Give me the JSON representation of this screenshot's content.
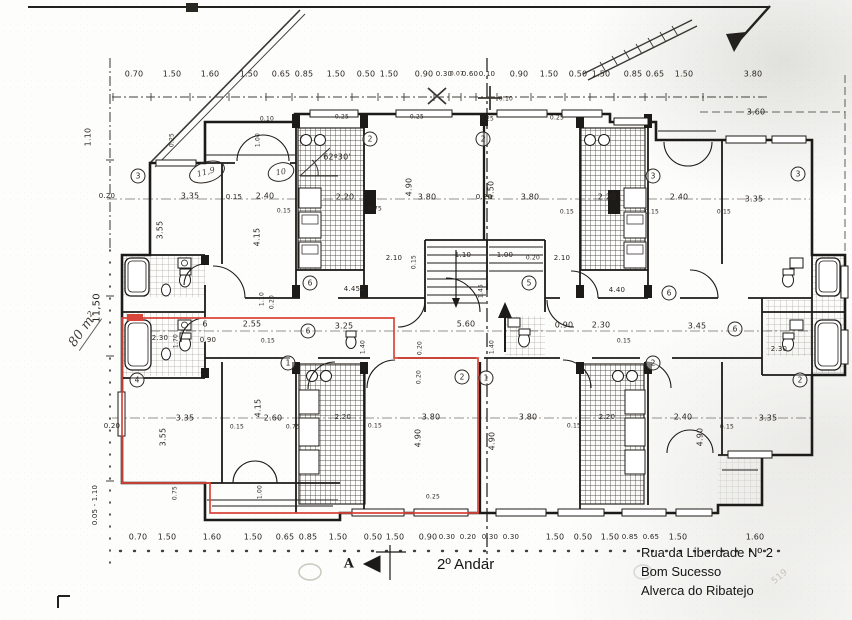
{
  "meta": {
    "title": "2º Andar",
    "address": [
      "Rua da Liberdade Nº 2",
      "Bom Sucesso",
      "Alverca do Ribatejo"
    ],
    "area_note": "80 m²",
    "section_marker": "A",
    "angle_note": "62º30'"
  },
  "colors": {
    "ink": "#2b2620",
    "highlight_red": "#d9453a",
    "paper": "#fdfdfb",
    "pencil_faint": "#c6c4b8"
  },
  "room_numbers": [
    {
      "t": "3",
      "x": 138,
      "y": 176
    },
    {
      "t": "2",
      "x": 370,
      "y": 139
    },
    {
      "t": "2",
      "x": 483,
      "y": 139
    },
    {
      "t": "3",
      "x": 653,
      "y": 176
    },
    {
      "t": "3",
      "x": 798,
      "y": 174
    },
    {
      "t": "6",
      "x": 310,
      "y": 283
    },
    {
      "t": "5",
      "x": 529,
      "y": 283
    },
    {
      "t": "6",
      "x": 308,
      "y": 331
    },
    {
      "t": "6",
      "x": 669,
      "y": 293
    },
    {
      "t": "6",
      "x": 735,
      "y": 329
    },
    {
      "t": "4",
      "x": 137,
      "y": 380
    },
    {
      "t": "1",
      "x": 288,
      "y": 363
    },
    {
      "t": "2",
      "x": 462,
      "y": 377
    },
    {
      "t": "1",
      "x": 486,
      "y": 378
    },
    {
      "t": "2",
      "x": 653,
      "y": 363
    },
    {
      "t": "2",
      "x": 800,
      "y": 380
    }
  ],
  "labels": [
    {
      "t": "0.70",
      "x": 134,
      "y": 74
    },
    {
      "t": "1.50",
      "x": 172,
      "y": 74
    },
    {
      "t": "1.60",
      "x": 210,
      "y": 74
    },
    {
      "t": "1.50",
      "x": 249,
      "y": 74
    },
    {
      "t": "0.65",
      "x": 281,
      "y": 74
    },
    {
      "t": "0.85",
      "x": 304,
      "y": 74
    },
    {
      "t": "1.50",
      "x": 336,
      "y": 74
    },
    {
      "t": "0.50",
      "x": 366,
      "y": 74
    },
    {
      "t": "1.50",
      "x": 389,
      "y": 74
    },
    {
      "t": "0.90",
      "x": 424,
      "y": 74
    },
    {
      "t": "0.30",
      "x": 444,
      "y": 74,
      "s": 7
    },
    {
      "t": "0.07",
      "x": 457,
      "y": 74,
      "s": 6
    },
    {
      "t": "0.60",
      "x": 470,
      "y": 74,
      "s": 7
    },
    {
      "t": "0.10",
      "x": 487,
      "y": 74,
      "s": 7
    },
    {
      "t": "0.90",
      "x": 519,
      "y": 74
    },
    {
      "t": "1.50",
      "x": 549,
      "y": 74
    },
    {
      "t": "0.50",
      "x": 578,
      "y": 74
    },
    {
      "t": "1.50",
      "x": 601,
      "y": 74
    },
    {
      "t": "0.85",
      "x": 633,
      "y": 74
    },
    {
      "t": "0.65",
      "x": 655,
      "y": 74
    },
    {
      "t": "1.50",
      "x": 684,
      "y": 74
    },
    {
      "t": "3.80",
      "x": 753,
      "y": 74
    },
    {
      "t": "0.10",
      "x": 506,
      "y": 99,
      "s": 6
    },
    {
      "t": "3.60",
      "x": 756,
      "y": 112
    },
    {
      "t": "0.70",
      "x": 138,
      "y": 537
    },
    {
      "t": "1.50",
      "x": 167,
      "y": 537
    },
    {
      "t": "1.60",
      "x": 212,
      "y": 537
    },
    {
      "t": "1.50",
      "x": 253,
      "y": 537
    },
    {
      "t": "0.65",
      "x": 285,
      "y": 537
    },
    {
      "t": "0.85",
      "x": 308,
      "y": 537
    },
    {
      "t": "1.50",
      "x": 338,
      "y": 537
    },
    {
      "t": "0.50",
      "x": 373,
      "y": 537
    },
    {
      "t": "1.50",
      "x": 395,
      "y": 537
    },
    {
      "t": "0.90",
      "x": 428,
      "y": 537
    },
    {
      "t": "0.30",
      "x": 447,
      "y": 537,
      "s": 7
    },
    {
      "t": "0.20",
      "x": 468,
      "y": 537,
      "s": 7
    },
    {
      "t": "0.30",
      "x": 490,
      "y": 537,
      "s": 7
    },
    {
      "t": "0.30",
      "x": 511,
      "y": 537,
      "s": 7
    },
    {
      "t": "1.50",
      "x": 555,
      "y": 537
    },
    {
      "t": "0.50",
      "x": 583,
      "y": 537
    },
    {
      "t": "1.50",
      "x": 610,
      "y": 537
    },
    {
      "t": "0.85",
      "x": 630,
      "y": 537,
      "s": 7
    },
    {
      "t": "0.65",
      "x": 651,
      "y": 537,
      "s": 7
    },
    {
      "t": "1.50",
      "x": 678,
      "y": 537
    },
    {
      "t": "1.60",
      "x": 755,
      "y": 537
    },
    {
      "t": "0.20",
      "x": 107,
      "y": 196,
      "s": 7
    },
    {
      "t": "3.35",
      "x": 190,
      "y": 196
    },
    {
      "t": "0.15",
      "x": 234,
      "y": 197,
      "s": 7
    },
    {
      "t": "2.40",
      "x": 265,
      "y": 196
    },
    {
      "t": "0.15",
      "x": 284,
      "y": 211,
      "s": 6
    },
    {
      "t": "2.20",
      "x": 345,
      "y": 197
    },
    {
      "t": "0.75",
      "x": 375,
      "y": 209,
      "s": 6
    },
    {
      "t": "3.80",
      "x": 427,
      "y": 197
    },
    {
      "t": "0.20",
      "x": 484,
      "y": 197,
      "s": 7
    },
    {
      "t": "3.80",
      "x": 530,
      "y": 197
    },
    {
      "t": "0.15",
      "x": 567,
      "y": 212,
      "s": 6
    },
    {
      "t": "2.20",
      "x": 607,
      "y": 197
    },
    {
      "t": "0.15",
      "x": 652,
      "y": 212,
      "s": 6
    },
    {
      "t": "2.40",
      "x": 679,
      "y": 197
    },
    {
      "t": "0.15",
      "x": 724,
      "y": 212,
      "s": 6
    },
    {
      "t": "3.35",
      "x": 754,
      "y": 199
    },
    {
      "t": "0.10",
      "x": 267,
      "y": 119,
      "s": 6
    },
    {
      "t": "0.25",
      "x": 342,
      "y": 117,
      "s": 6
    },
    {
      "t": "0.25",
      "x": 417,
      "y": 117,
      "s": 6
    },
    {
      "t": "0.25",
      "x": 487,
      "y": 119,
      "s": 6
    },
    {
      "t": "0.25",
      "x": 557,
      "y": 118,
      "s": 6
    },
    {
      "t": "1.00",
      "x": 258,
      "y": 140,
      "r": -90,
      "s": 6
    },
    {
      "t": "0.25",
      "x": 172,
      "y": 140,
      "r": -90,
      "s": 6
    },
    {
      "t": "3.55",
      "x": 160,
      "y": 230,
      "r": -90
    },
    {
      "t": "4.15",
      "x": 257,
      "y": 237,
      "r": -90
    },
    {
      "t": "4.90",
      "x": 409,
      "y": 187,
      "r": -90
    },
    {
      "t": "4.50",
      "x": 491,
      "y": 190,
      "r": -90
    },
    {
      "t": "1.10",
      "x": 262,
      "y": 299,
      "r": -90,
      "s": 6
    },
    {
      "t": "0.20",
      "x": 272,
      "y": 302,
      "r": -90,
      "s": 6
    },
    {
      "t": "2.10",
      "x": 394,
      "y": 258,
      "s": 7
    },
    {
      "t": "1.10",
      "x": 463,
      "y": 255,
      "s": 7
    },
    {
      "t": "1.00",
      "x": 505,
      "y": 255,
      "s": 7
    },
    {
      "t": "0.20",
      "x": 533,
      "y": 258,
      "s": 6
    },
    {
      "t": "2.10",
      "x": 562,
      "y": 258,
      "s": 7
    },
    {
      "t": "0.15",
      "x": 414,
      "y": 262,
      "r": -90,
      "s": 6
    },
    {
      "t": "4.45",
      "x": 352,
      "y": 289,
      "s": 7
    },
    {
      "t": "4.40",
      "x": 617,
      "y": 290,
      "s": 7
    },
    {
      "t": "1.45",
      "x": 363,
      "y": 291,
      "r": -90,
      "s": 6
    },
    {
      "t": "1.45",
      "x": 481,
      "y": 291,
      "r": -90,
      "s": 6
    },
    {
      "t": "6",
      "x": 205,
      "y": 324
    },
    {
      "t": "2.55",
      "x": 252,
      "y": 324
    },
    {
      "t": "0.90",
      "x": 208,
      "y": 340,
      "s": 7
    },
    {
      "t": "3.25",
      "x": 344,
      "y": 326
    },
    {
      "t": "5.60",
      "x": 466,
      "y": 324
    },
    {
      "t": "0.90",
      "x": 564,
      "y": 325
    },
    {
      "t": "2.30",
      "x": 601,
      "y": 325
    },
    {
      "t": "3.45",
      "x": 697,
      "y": 326
    },
    {
      "t": "2.30",
      "x": 160,
      "y": 338,
      "s": 7
    },
    {
      "t": "1.70",
      "x": 176,
      "y": 341,
      "r": -90,
      "s": 6
    },
    {
      "t": "2.30",
      "x": 779,
      "y": 349,
      "s": 7
    },
    {
      "t": "0.15",
      "x": 268,
      "y": 341,
      "s": 6
    },
    {
      "t": "0.15",
      "x": 624,
      "y": 341,
      "s": 6
    },
    {
      "t": "1.40",
      "x": 363,
      "y": 347,
      "r": -90,
      "s": 6
    },
    {
      "t": "1.40",
      "x": 492,
      "y": 347,
      "r": -90,
      "s": 6
    },
    {
      "t": "0.20",
      "x": 420,
      "y": 348,
      "r": -90,
      "s": 6
    },
    {
      "t": "3.35",
      "x": 185,
      "y": 418
    },
    {
      "t": "0.15",
      "x": 237,
      "y": 427,
      "s": 6
    },
    {
      "t": "2.60",
      "x": 273,
      "y": 418
    },
    {
      "t": "0.75",
      "x": 293,
      "y": 427,
      "s": 6
    },
    {
      "t": "2.20",
      "x": 343,
      "y": 417,
      "s": 7
    },
    {
      "t": "3.80",
      "x": 431,
      "y": 417
    },
    {
      "t": "0.15",
      "x": 375,
      "y": 426,
      "s": 6
    },
    {
      "t": "3.80",
      "x": 528,
      "y": 417
    },
    {
      "t": "0.15",
      "x": 574,
      "y": 426,
      "s": 6
    },
    {
      "t": "2.20",
      "x": 607,
      "y": 417,
      "s": 7
    },
    {
      "t": "2.40",
      "x": 683,
      "y": 417
    },
    {
      "t": "0.15",
      "x": 727,
      "y": 427,
      "s": 6
    },
    {
      "t": "3.35",
      "x": 768,
      "y": 418
    },
    {
      "t": "0.20",
      "x": 112,
      "y": 426,
      "s": 7
    },
    {
      "t": "3.55",
      "x": 163,
      "y": 437,
      "r": -90
    },
    {
      "t": "4.15",
      "x": 258,
      "y": 408,
      "r": -90
    },
    {
      "t": "4.90",
      "x": 418,
      "y": 438,
      "r": -90
    },
    {
      "t": "4.90",
      "x": 492,
      "y": 441,
      "r": -90
    },
    {
      "t": "4.90",
      "x": 700,
      "y": 437,
      "r": -90
    },
    {
      "t": "0.20",
      "x": 419,
      "y": 377,
      "r": -90,
      "s": 6
    },
    {
      "t": "0.75",
      "x": 175,
      "y": 493,
      "r": -90,
      "s": 6
    },
    {
      "t": "1.00",
      "x": 260,
      "y": 492,
      "r": -90,
      "s": 6
    },
    {
      "t": "0.25",
      "x": 433,
      "y": 497,
      "s": 6
    },
    {
      "t": "11,50",
      "x": 97,
      "y": 308,
      "r": -90,
      "s": 10
    },
    {
      "t": "1.10",
      "x": 88,
      "y": 137,
      "r": -90
    },
    {
      "t": "0.05 - 1.10",
      "x": 95,
      "y": 505,
      "r": -90,
      "s": 7
    },
    {
      "t": "62º30'",
      "x": 337,
      "y": 157
    },
    {
      "t": "80 m²",
      "x": 84,
      "y": 330,
      "r": -55,
      "s": 13,
      "c": "hand und",
      "n": "area-note"
    },
    {
      "t": "11,9",
      "x": 206,
      "y": 172,
      "r": -15,
      "s": 8,
      "c": "hand",
      "n": "room-area-note"
    },
    {
      "t": "10",
      "x": 281,
      "y": 172,
      "r": -10,
      "s": 8,
      "c": "hand",
      "n": "room-area-note"
    },
    {
      "t": "519",
      "x": 780,
      "y": 577,
      "r": -40,
      "s": 9,
      "c": "faint",
      "n": "pencil-note"
    },
    {
      "t": "A",
      "x": 349,
      "y": 564,
      "s": 13,
      "c": "mark",
      "n": "section-marker"
    }
  ]
}
